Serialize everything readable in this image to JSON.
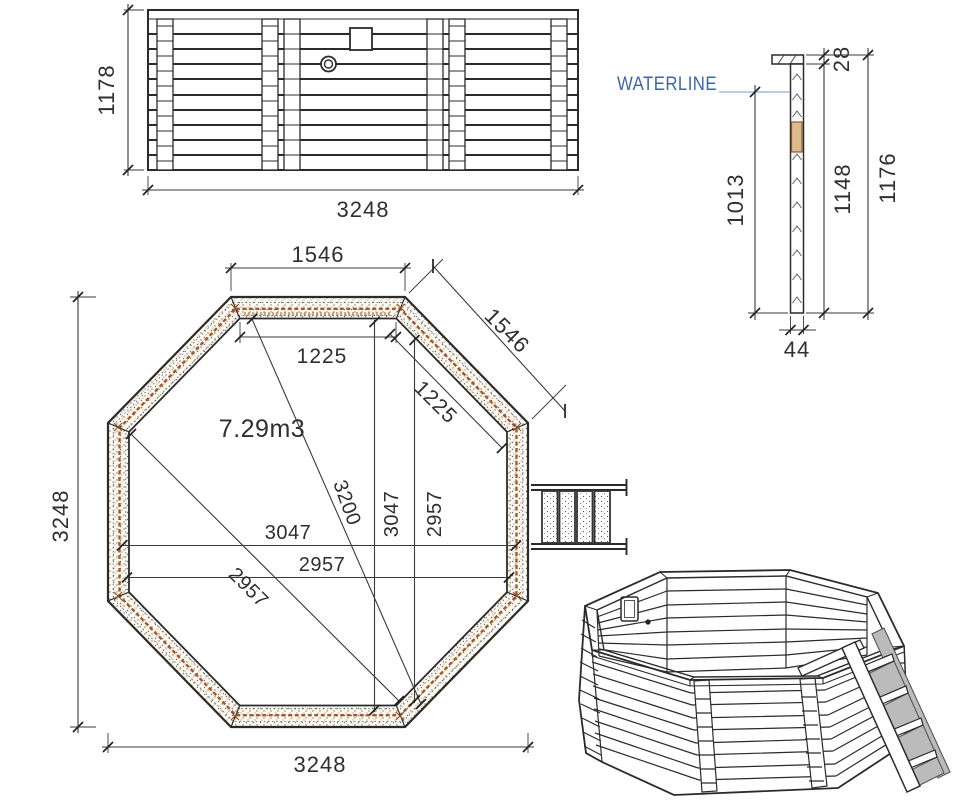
{
  "colors": {
    "line": "#2b2b2b",
    "dim_text": "#2f2f2f",
    "waterline_text": "#3a66ad",
    "waterline_line": "#a9c6e8",
    "wood_accent": "#a3592a",
    "wood_infill": "#dcbb8e",
    "ladder_shade": "#bbbbbb",
    "background": "#ffffff"
  },
  "elevation": {
    "height": "1178",
    "width": "3248"
  },
  "section": {
    "waterline_label": "WATERLINE",
    "rim_height": "28",
    "water_depth": "1013",
    "wall_height": "1148",
    "total_height": "1176",
    "wall_thickness": "44"
  },
  "plan": {
    "volume": "7.29m3",
    "top_edge": "1546",
    "diagonal_edge": "1546",
    "inner_top_edge": "1225",
    "inner_diagonal_edge": "1225",
    "overall_width": "3248",
    "overall_height": "3248",
    "inner_width_a": "3047",
    "inner_width_b": "2957",
    "inner_height_a": "3047",
    "inner_height_b": "2957",
    "diagonal_a": "3200",
    "diagonal_b": "2957"
  }
}
